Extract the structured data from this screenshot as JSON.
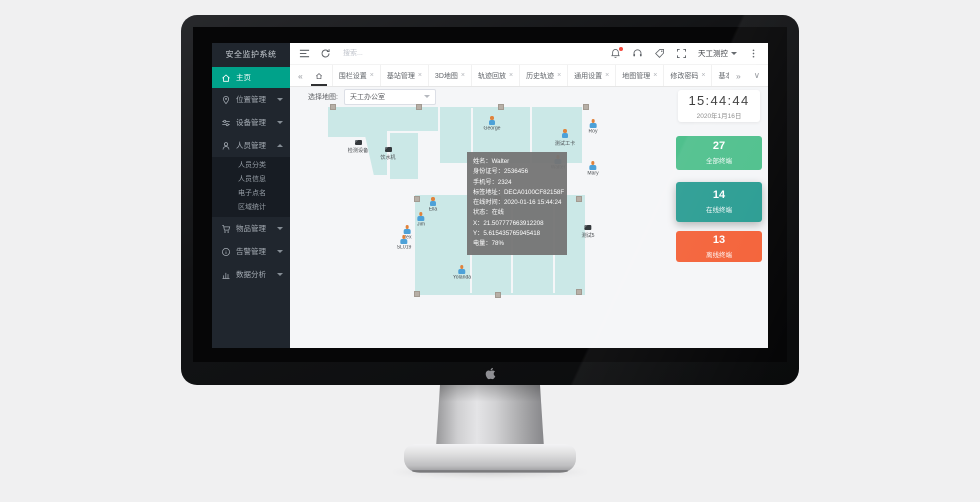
{
  "app": {
    "title": "安全监护系统"
  },
  "sidebar": {
    "items": [
      {
        "label": "主页",
        "icon": "home-icon",
        "active": true
      },
      {
        "label": "位置管理",
        "icon": "location-icon",
        "arrow": "down"
      },
      {
        "label": "设备管理",
        "icon": "device-icon",
        "arrow": "down"
      },
      {
        "label": "人员管理",
        "icon": "person-icon",
        "arrow": "up",
        "children": [
          "人员分类",
          "人员信息",
          "电子点名",
          "区域统计"
        ]
      },
      {
        "label": "物品管理",
        "icon": "cart-icon",
        "arrow": "down"
      },
      {
        "label": "告警管理",
        "icon": "alarm-icon",
        "arrow": "down"
      },
      {
        "label": "数据分析",
        "icon": "chart-icon",
        "arrow": "down"
      }
    ]
  },
  "toolbar": {
    "search_placeholder": "搜索...",
    "user_name": "天工测控"
  },
  "tabbar": {
    "scroll_left": "«",
    "scroll_right": "»",
    "collapse": "∨",
    "tabs": [
      {
        "label": "围栏设置",
        "closable": true
      },
      {
        "label": "基站管理",
        "closable": true
      },
      {
        "label": "3D地图",
        "closable": true
      },
      {
        "label": "轨迹回放",
        "closable": true
      },
      {
        "label": "历史轨迹",
        "closable": true
      },
      {
        "label": "通用设置",
        "closable": true
      },
      {
        "label": "地图管理",
        "closable": true
      },
      {
        "label": "修改密码",
        "closable": true
      },
      {
        "label": "基本资料",
        "closable": false
      }
    ]
  },
  "map": {
    "select_label": "选择地图:",
    "selected_map": "天工办公室",
    "rooms": [
      {
        "x": 8,
        "y": 2,
        "w": 52,
        "h": 30
      },
      {
        "x": 45,
        "y": 2,
        "w": 22,
        "h": 68,
        "diag": true
      },
      {
        "x": 70,
        "y": 28,
        "w": 28,
        "h": 46
      },
      {
        "x": 62,
        "y": 2,
        "w": 56,
        "h": 24
      },
      {
        "x": 120,
        "y": 2,
        "w": 90,
        "h": 56
      },
      {
        "x": 212,
        "y": 2,
        "w": 50,
        "h": 56
      },
      {
        "x": 95,
        "y": 90,
        "w": 170,
        "h": 100
      }
    ],
    "lines": [
      {
        "x": 151,
        "y": 3,
        "w": 1.5,
        "h": 54
      },
      {
        "x": 150,
        "y": 92,
        "w": 1.5,
        "h": 96
      },
      {
        "x": 191,
        "y": 92,
        "w": 1.5,
        "h": 96
      },
      {
        "x": 233,
        "y": 92,
        "w": 1.5,
        "h": 96
      }
    ],
    "anchors": [
      [
        13,
        2
      ],
      [
        99,
        2
      ],
      [
        181,
        2
      ],
      [
        266,
        2
      ],
      [
        97,
        94
      ],
      [
        178,
        94
      ],
      [
        259,
        94
      ],
      [
        97,
        189
      ],
      [
        178,
        190
      ],
      [
        259,
        187
      ]
    ],
    "persons": [
      {
        "name": "George",
        "x": 172,
        "y": 11
      },
      {
        "name": "Roy",
        "x": 273,
        "y": 14
      },
      {
        "name": "测试工卡",
        "x": 245,
        "y": 24
      },
      {
        "name": "Walter",
        "x": 238,
        "y": 50
      },
      {
        "name": "Mary",
        "x": 273,
        "y": 56
      },
      {
        "name": "Ella",
        "x": 113,
        "y": 92
      },
      {
        "name": "Jim",
        "x": 101,
        "y": 107
      },
      {
        "name": "Rex",
        "x": 87,
        "y": 120
      },
      {
        "name": "SL019",
        "x": 84,
        "y": 130
      },
      {
        "name": "Yolanda",
        "x": 142,
        "y": 160
      }
    ],
    "items": [
      {
        "name": "检测设备",
        "x": 38,
        "y": 35
      },
      {
        "name": "饮水机",
        "x": 68,
        "y": 42
      },
      {
        "name": "测试5",
        "x": 268,
        "y": 120
      }
    ],
    "tooltip": {
      "x": 147,
      "y": 47,
      "rows": [
        {
          "label": "姓名",
          "value": "Walter"
        },
        {
          "label": "身份证号",
          "value": "2536456"
        },
        {
          "label": "手机号",
          "value": "2324"
        },
        {
          "label": "标签地址",
          "value": "DECA0100CF82158F"
        },
        {
          "label": "在线时间",
          "value": "2020-01-16 15:44:24"
        },
        {
          "label": "状态",
          "value": "在线"
        },
        {
          "label": "X",
          "value": "21.507777663912208"
        },
        {
          "label": "Y",
          "value": "5.615435765945418"
        },
        {
          "label": "电量",
          "value": "78%"
        }
      ]
    }
  },
  "clock": {
    "time": "15:44:44",
    "date": "2020年1月16日"
  },
  "stats": {
    "cards": [
      {
        "value": "27",
        "label": "全部终端",
        "color": "#4fc08d"
      },
      {
        "value": "14",
        "label": "在线终端",
        "color": "#2b9d93",
        "shadow": true
      },
      {
        "value": "13",
        "label": "离线终端",
        "color": "#f4633a"
      }
    ]
  },
  "colors": {
    "accent": "#00a28a",
    "sidebar_bg": "#20262e",
    "submenu_bg": "#171c23"
  }
}
